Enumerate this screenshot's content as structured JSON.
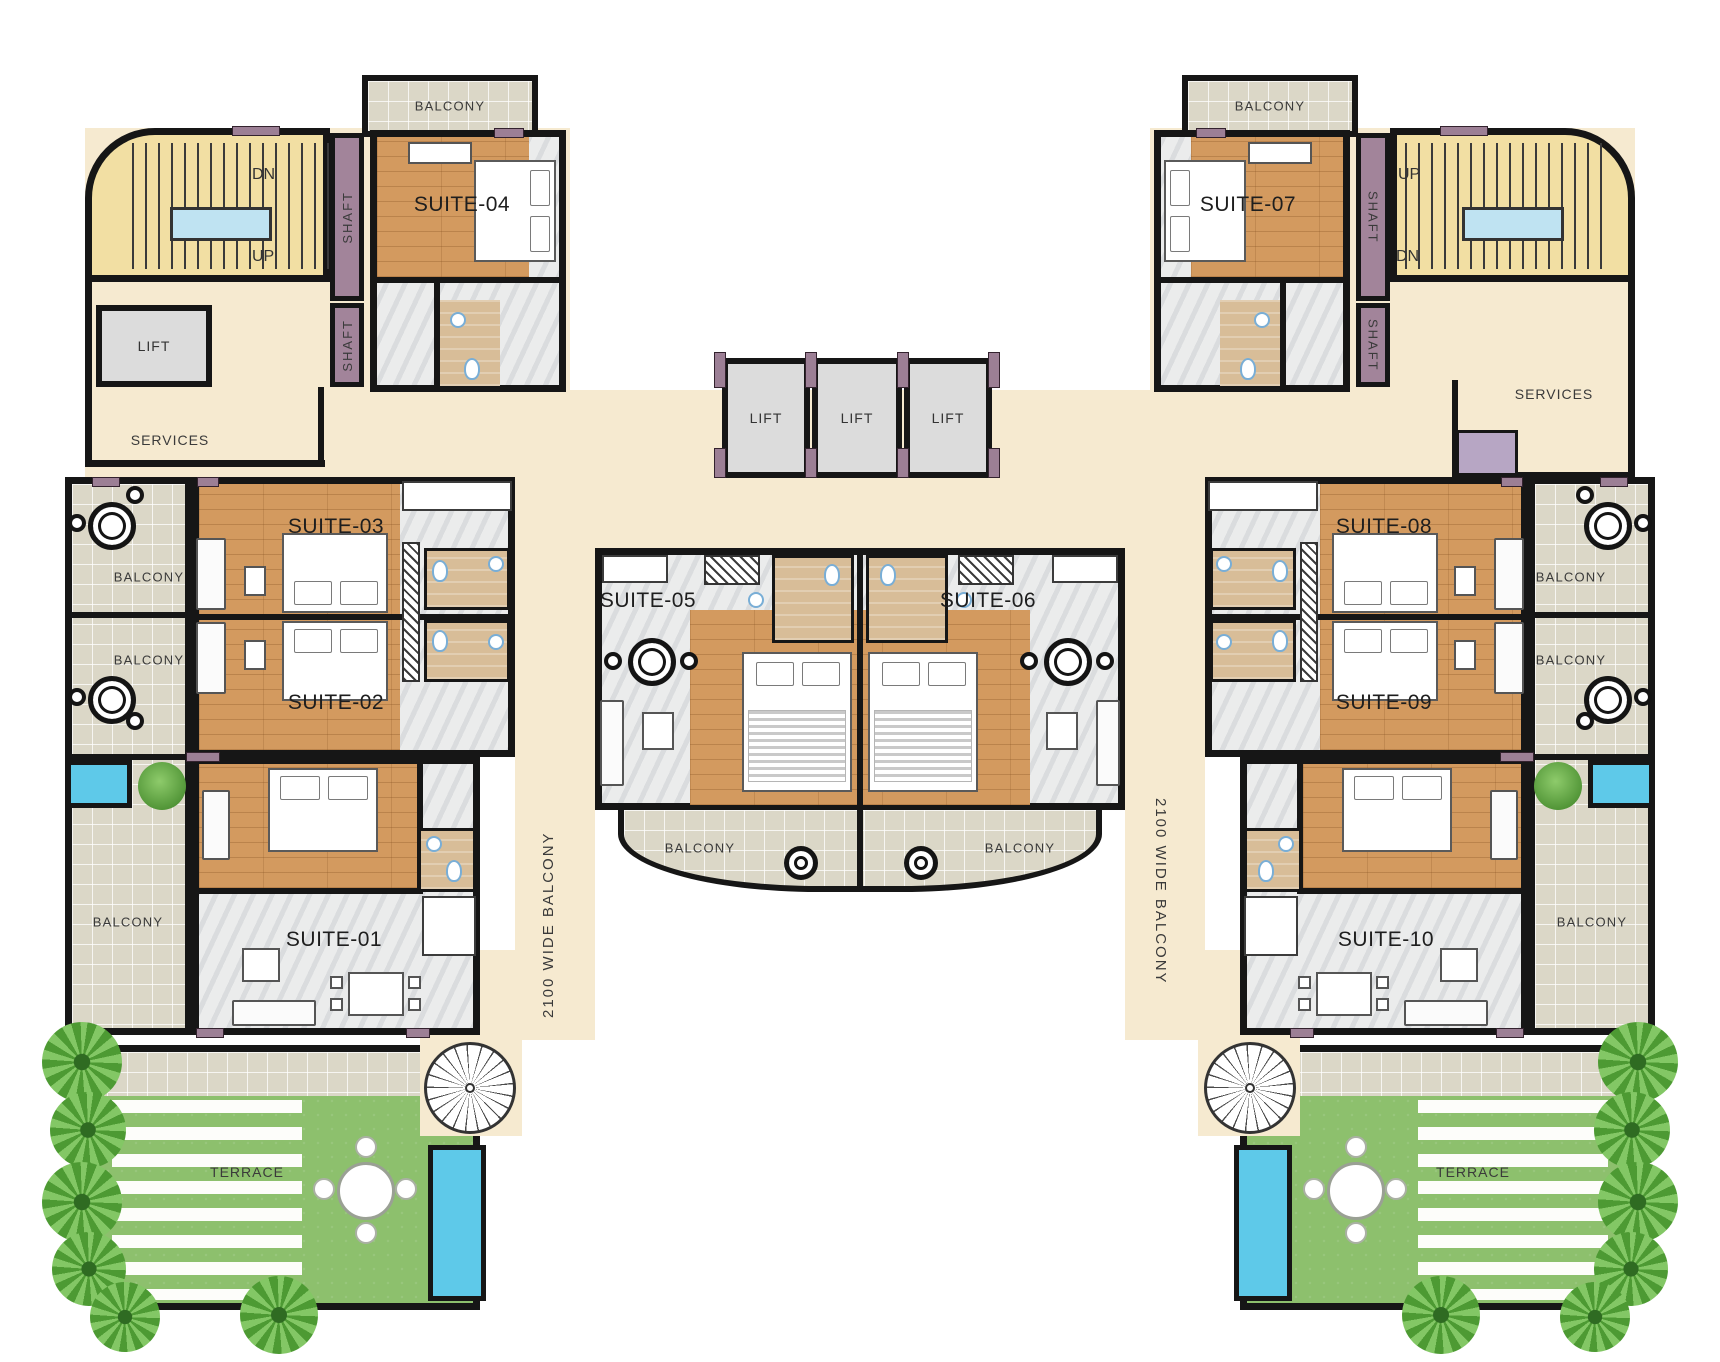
{
  "labels": {
    "balcony": "BALCONY",
    "terrace": "TERRACE",
    "lift": "LIFT",
    "shaft": "SHAFT",
    "services": "SERVICES",
    "up": "UP",
    "dn": "DN",
    "wide_balcony": "2100 WIDE BALCONY"
  },
  "suites": [
    {
      "id": "suite-01",
      "label": "SUITE-01"
    },
    {
      "id": "suite-02",
      "label": "SUITE-02"
    },
    {
      "id": "suite-03",
      "label": "SUITE-03"
    },
    {
      "id": "suite-04",
      "label": "SUITE-04"
    },
    {
      "id": "suite-05",
      "label": "SUITE-05"
    },
    {
      "id": "suite-06",
      "label": "SUITE-06"
    },
    {
      "id": "suite-07",
      "label": "SUITE-07"
    },
    {
      "id": "suite-08",
      "label": "SUITE-08"
    },
    {
      "id": "suite-09",
      "label": "SUITE-09"
    },
    {
      "id": "suite-10",
      "label": "SUITE-10"
    }
  ],
  "colors": {
    "wall": "#161616",
    "corridor_beige": "#f6ead0",
    "stair_yellow": "#f2dfa3",
    "shaft_mauve": "#a2849a",
    "accent_mauve": "#9c7f95",
    "lift_gray": "#dcdcdc",
    "services_lift_purple": "#b7a6c4",
    "wood_floor": "#d39a5f",
    "bathroom_tan": "#d8bd98",
    "balcony_tile": "#dbd7c7",
    "marble": "#ebecec",
    "terrace_green": "#8dc06d",
    "pool_blue": "#5ec9e9",
    "stair_landing_blue": "#bfe3f2",
    "fixture_blue": "#79aed6",
    "palm_green": "#57a23b"
  }
}
